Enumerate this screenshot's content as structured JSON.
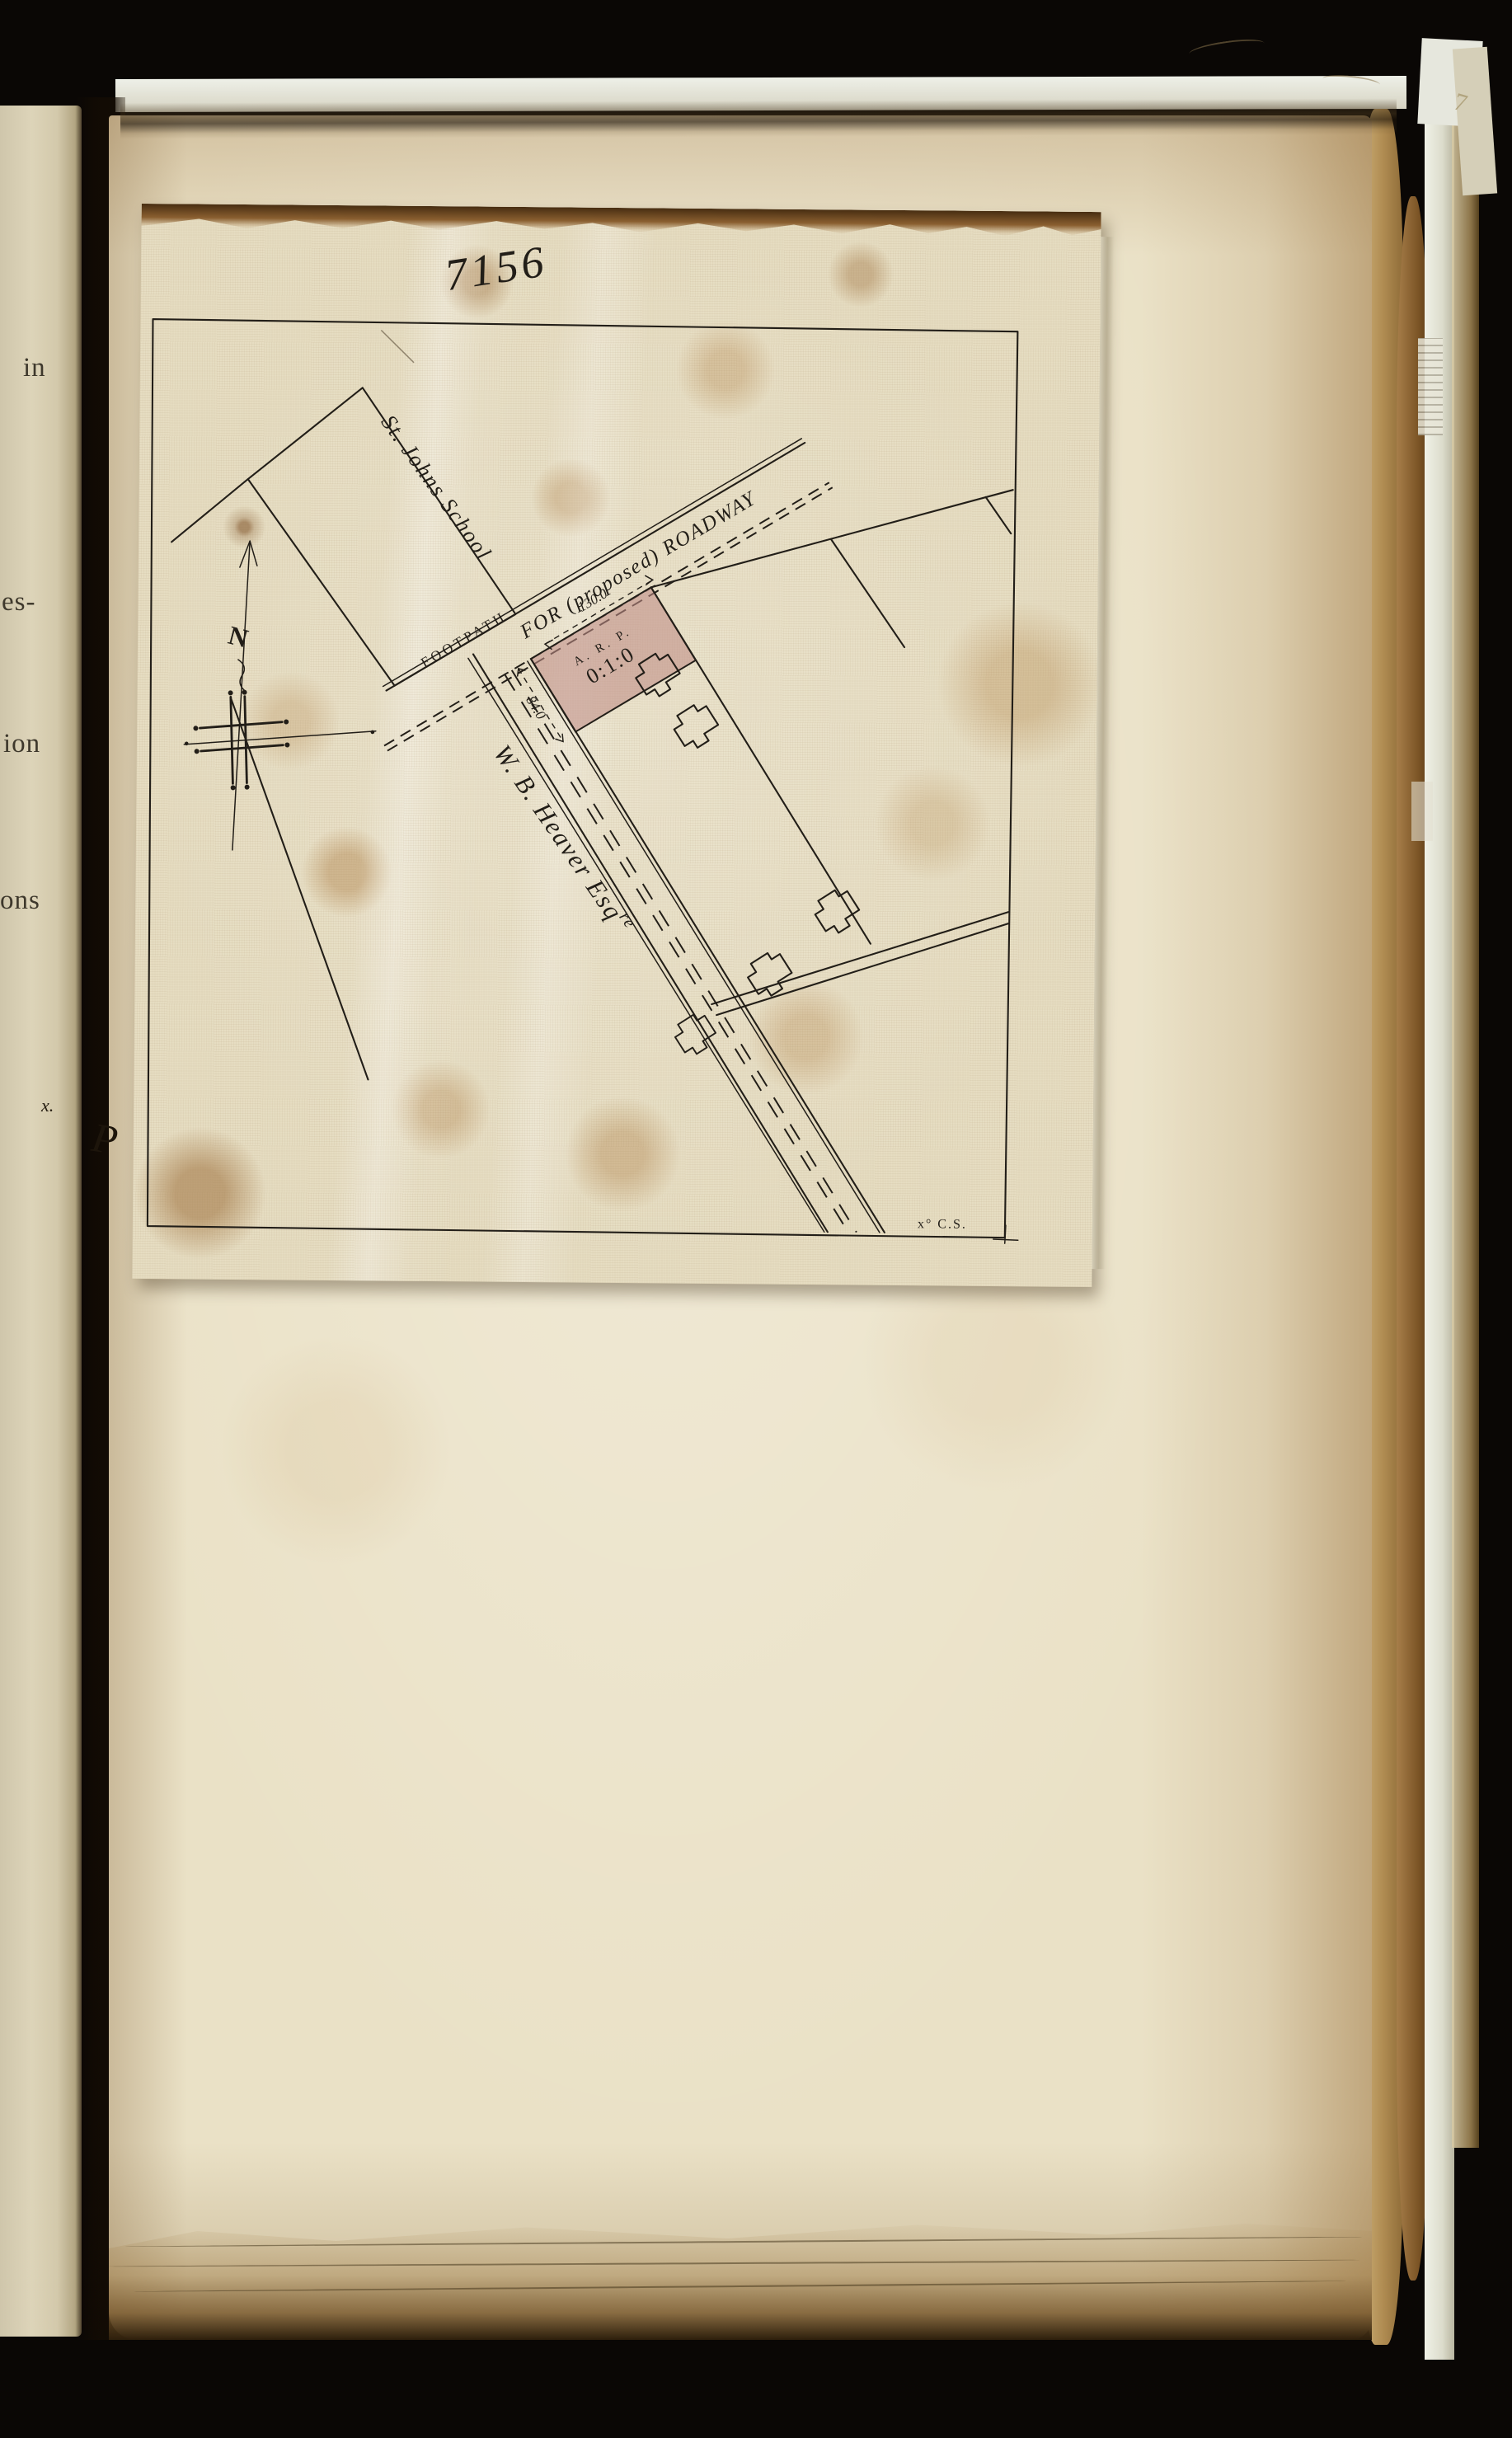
{
  "book": {
    "left_page_fragments": [
      "in",
      "es-",
      "ion",
      "ons"
    ],
    "left_margin_mark": "x.",
    "gutter_mark": "P",
    "edge_mark": "7"
  },
  "map": {
    "plan_number": "7156",
    "school_label": "St. Johns School",
    "footpath_label": "FOOTPATH",
    "roadway_label": "FOR (proposed) ROADWAY",
    "owner_label": "W. B. Heaver Esq",
    "owner_suffix": "re",
    "compass_letter": "N",
    "surveyor_mark": "x° C.S.",
    "plot": {
      "frontage_dimension": "130.0",
      "side_dimension": "84.0",
      "area_header": "A. R. P.",
      "area_value": "0:1:0",
      "fill_color": "#bf8e87"
    },
    "colors": {
      "ink": "#221e18",
      "linen": "#e6ddc2",
      "page": "#eae1c6"
    }
  }
}
